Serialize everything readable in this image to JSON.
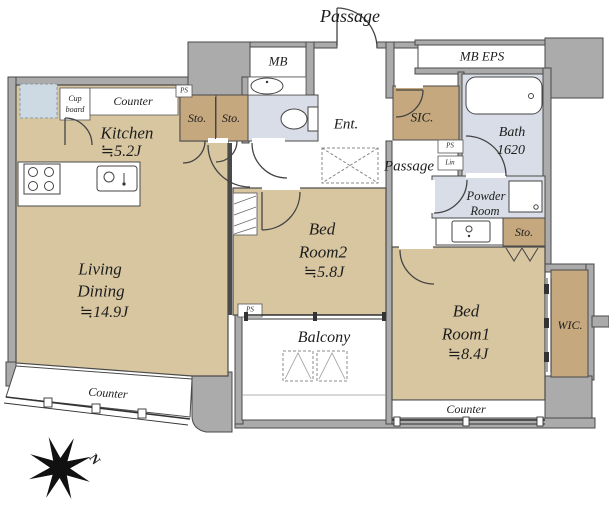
{
  "title": "Apartment floor plan",
  "colors": {
    "wall_gray": "#ababab",
    "floor_beige": "#d8c6a1",
    "storage_brown": "#c6a87e",
    "wet_blue": "#d9dde7",
    "fridge_blue": "#cdd9e3",
    "text": "#1d1d1d"
  },
  "labels": {
    "passage_top": "Passage",
    "mb": "MB",
    "mb_eps": "MB EPS",
    "cupboard_line1": "Cup",
    "cupboard_line2": "board",
    "counter": "Counter",
    "ps": "PS",
    "lin": "Lin",
    "sto": "Sto.",
    "kitchen_name": "Kitchen",
    "kitchen_size": "≒5.2J",
    "ent": "Ent.",
    "sic": "SIC.",
    "passage_inner": "Passage",
    "bath_name": "Bath",
    "bath_size": "1620",
    "powder_line1": "Powder",
    "powder_line2": "Room",
    "bed2_line1": "Bed",
    "bed2_line2": "Room2",
    "bed2_size": "≒5.8J",
    "living_line1": "Living",
    "living_line2": "Dining",
    "living_size": "≒14.9J",
    "balcony": "Balcony",
    "bed1_line1": "Bed",
    "bed1_line2": "Room1",
    "bed1_size": "≒8.4J",
    "wic": "WIC.",
    "compass_north": "N"
  }
}
